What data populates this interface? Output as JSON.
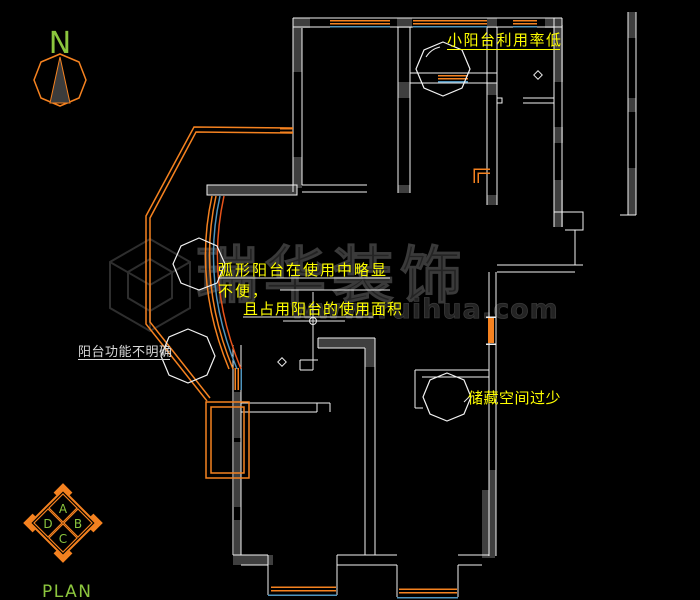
{
  "drawing": {
    "type": "apartment floor plan (CAD)",
    "plan_label": "PLAN",
    "north_indicator": {
      "label": "N"
    }
  },
  "annotations": {
    "small_balcony": "小阳台利用率低",
    "arc_balcony_line1": "弧形阳台在使用中略显",
    "arc_balcony_line2": "不便，",
    "arc_balcony_line3": "且占用阳台的使用面积",
    "balcony_function": "阳台功能不明确",
    "storage": "储藏空间过少"
  },
  "compass": {
    "top": "A",
    "right": "B",
    "bottom": "C",
    "left": "D"
  },
  "watermark": {
    "name": "瑞华装饰",
    "url": "www.ruihua.com"
  },
  "colors": {
    "background": "#000000",
    "wall_line": "#f2f2f2",
    "wall_fill": "#3f3f3f",
    "window_orange": "#f58220",
    "window_blue": "#4f94bd",
    "annotation_yellow": "#ffff00",
    "annotation_white": "#d8d8d8",
    "label_green": "#8cc63e",
    "watermark_gray": "#2a2a2a"
  }
}
